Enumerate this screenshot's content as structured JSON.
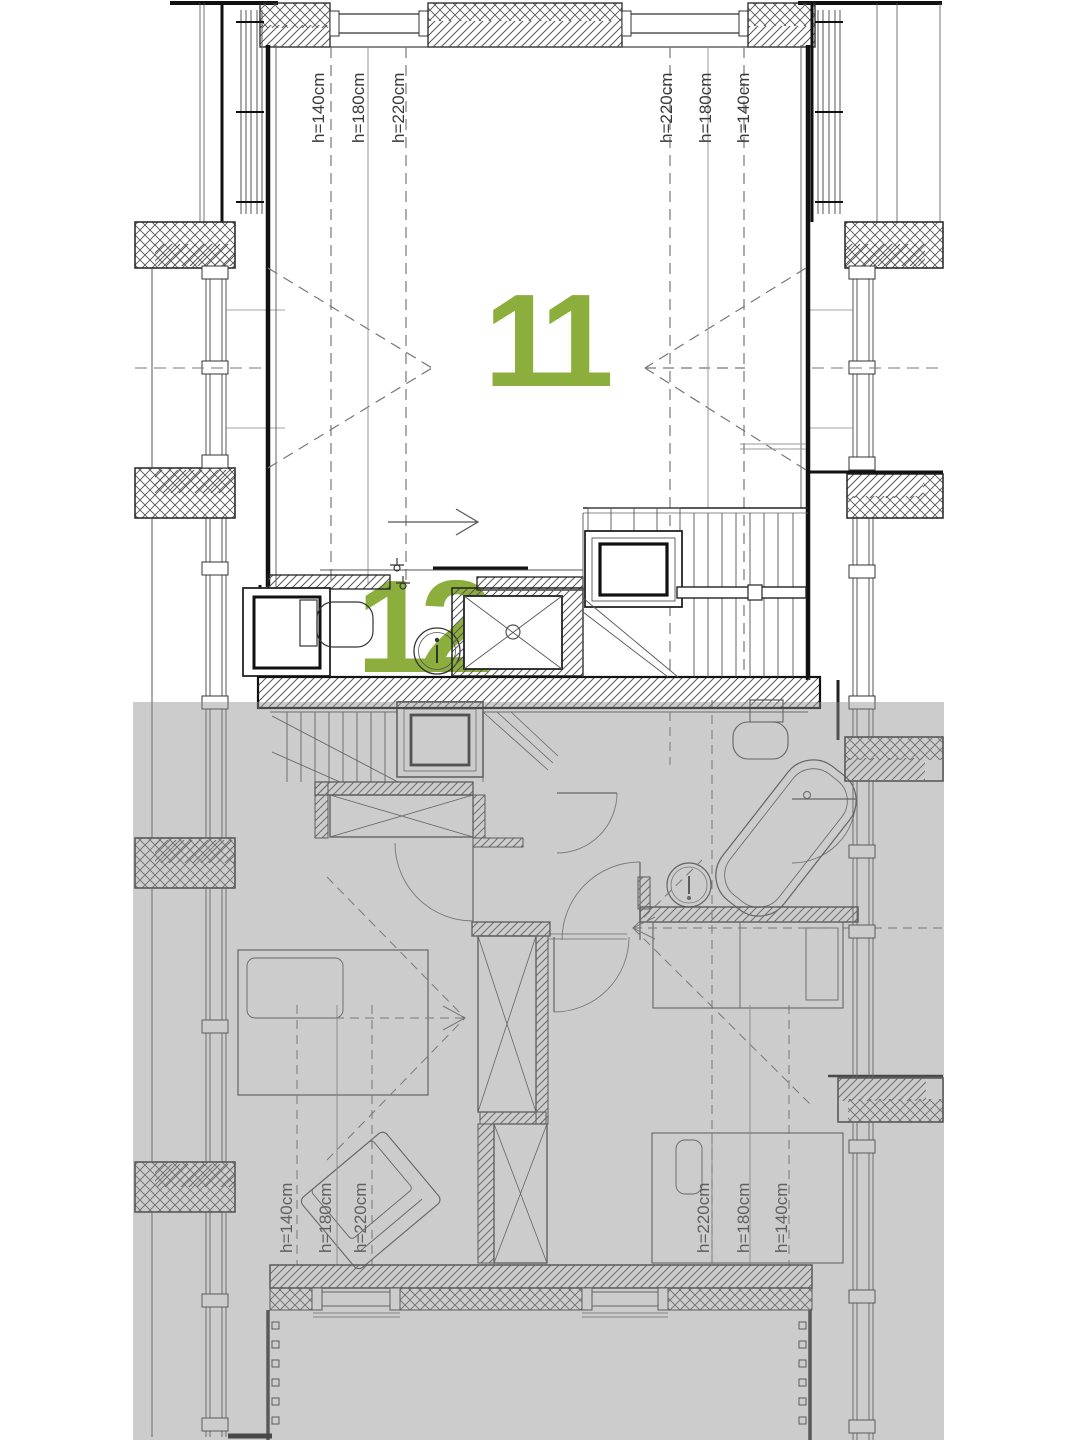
{
  "plan": {
    "accent_color": "#8cae3c",
    "overlay": {
      "color": "#8f8f8f",
      "opacity": "0.45"
    },
    "room_numbers": {
      "attic_room": "11",
      "attic_bath": "12"
    },
    "height_labels": {
      "top_left": [
        "h=140cm",
        "h=180cm",
        "h=220cm"
      ],
      "top_right": [
        "h=220cm",
        "h=180cm",
        "h=140cm"
      ],
      "bottom_left": [
        "h=140cm",
        "h=180cm",
        "h=220cm"
      ],
      "bottom_right": [
        "h=220cm",
        "h=180cm",
        "h=140cm"
      ]
    }
  }
}
